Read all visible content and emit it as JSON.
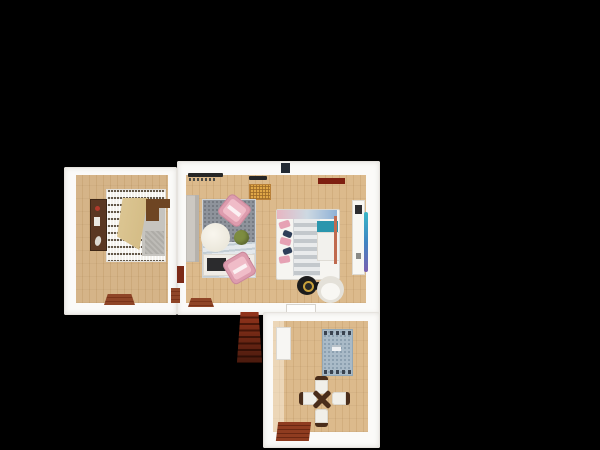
{
  "scene": {
    "kind": "3d-floorplan-top-down-render",
    "background_color": "#000000",
    "wall_color": "#fbfaf8",
    "wood_floor_color": "#d8b487"
  },
  "rooms": {
    "bedroom": {
      "furniture": [
        "sideboard-cabinet",
        "black-white-patterned-rug",
        "bed-gray-mattress",
        "tan-quilt",
        "wood-headboard",
        "door-threshold"
      ]
    },
    "living_room": {
      "furniture": [
        "window-sill-decor",
        "waffle-doormat",
        "gray-wall-sofa",
        "two-tone-area-rug",
        "round-white-table",
        "green-pouf",
        "pink-armchair-upper",
        "pink-armchair-lower",
        "dark-media-bench",
        "red-radiator",
        "door-thresholds"
      ]
    },
    "sleeping_nook": {
      "furniture": [
        "double-bed-striped-duvet",
        "pink-pillows",
        "navy-pillows",
        "teal-side-unit",
        "white-blanket",
        "round-black-gold-rug",
        "white-tub-chair",
        "tall-white-cabinet",
        "gradient-board-art",
        "white-door-threshold"
      ]
    },
    "dining_room": {
      "furniture": [
        "white-door-leaf",
        "blue-fringed-rug",
        "x-base-dining-table",
        "white-chair-north",
        "white-chair-south",
        "white-chair-west",
        "white-chair-east",
        "entry-mat"
      ]
    },
    "staircase": {
      "description": "dark red wooden steps leading down"
    }
  },
  "palette": {
    "pouf_green": "#7d8c40",
    "armchair_pink": "#dd9cae",
    "teal_unit": "#2a96ad",
    "radiator_red": "#7c2a17",
    "door_header_red": "#7e1f10",
    "headboard_brown": "#6e4523",
    "stairs_red": "#93341b",
    "rug_blue": "#a9bac7",
    "rug_living_gray": "#8e939b",
    "doormat_yellow": "#e0a747",
    "quilt_tan": "#d9c28f",
    "threshold_brown": "#8f4527",
    "chair_frame_brown": "#4a2d1a"
  }
}
